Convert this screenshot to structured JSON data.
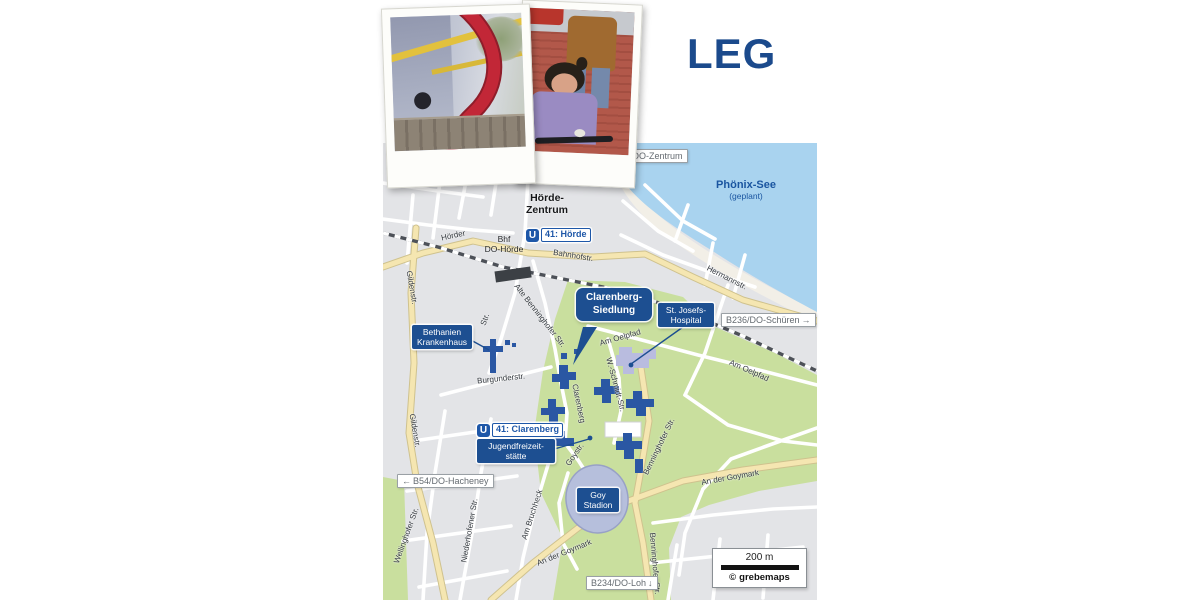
{
  "logo": {
    "text": "LEG",
    "color": "#1b4a8c"
  },
  "photos": {
    "left": "playground-red-sculpture-photo",
    "right": "child-on-bike-photo"
  },
  "map": {
    "lake_label": {
      "title": "Phönix-See",
      "subtitle": "(geplant)"
    },
    "district": {
      "line1": "Hörde-",
      "line2": "Zentrum"
    },
    "station_bhf": {
      "line1": "Bhf",
      "line2": "DO-Hörde"
    },
    "ubahn": [
      {
        "logo": "U",
        "label": "41: Hörde"
      },
      {
        "logo": "U",
        "label": "41: Clarenberg"
      }
    ],
    "poi": {
      "bethanien": {
        "line1": "Bethanien",
        "line2": "Krankenhaus"
      },
      "st_josefs": {
        "line1": "St. Josefs-",
        "line2": "Hospital"
      },
      "jugend": {
        "line1": "Jugendfreizeit-",
        "line2": "stätte"
      },
      "goy_stadion": {
        "line1": "Goy",
        "line2": "Stadion"
      }
    },
    "callout": {
      "line1": "Clarenberg-",
      "line2": "Siedlung"
    },
    "signs": {
      "do_zentrum": {
        "arrow": "↑",
        "label": "DO-Zentrum"
      },
      "b54": {
        "arrow": "←",
        "label": "B54/DO-Hacheney"
      },
      "b236": {
        "arrow": "→",
        "label": "B236/DO-Schüren"
      },
      "b234": {
        "arrow": "↓",
        "label": "B234/DO-Loh"
      }
    },
    "streets": [
      "Hörder",
      "Bahnhofstr.",
      "Hermannstr.",
      "Gildenstr.",
      "Gildenstr.",
      "Wellinghofer Str.",
      "Niederhofener Str.",
      "Am Bruchheck",
      "Burgunderstr.",
      "Alte Benninghofer Str.",
      "Am Oelpfad",
      "Am Oelpfad",
      "W.-Schmidt-Str.",
      "Clarenberg",
      "Benninghofer Str.",
      "Benninghofer Str.",
      "Goystr.",
      "An der Goymark",
      "An der Goymark",
      "Str."
    ],
    "scale": {
      "distance": "200 m",
      "copyright": "©",
      "credit": "grebemaps"
    },
    "colors": {
      "water": "#a9d3ef",
      "green": "#c9df9e",
      "road_yellow": "#f5e6b1",
      "label_blue": "#1d4f91",
      "building_blue": "#2a57a3"
    }
  }
}
